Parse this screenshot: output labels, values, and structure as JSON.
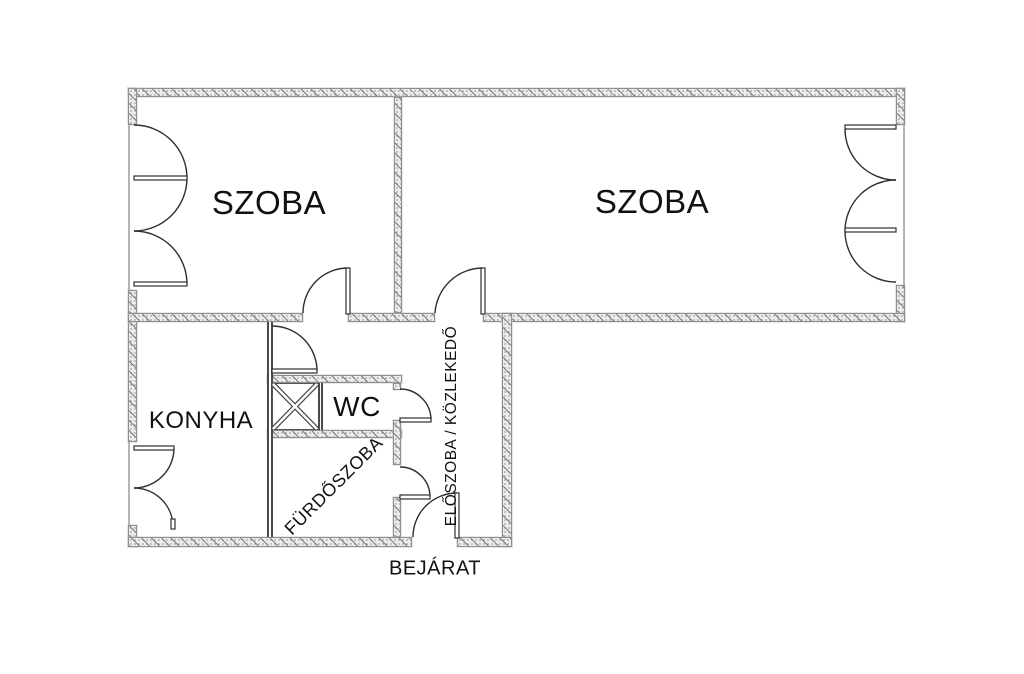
{
  "floorplan": {
    "labels": {
      "szoba_left": "SZOBA",
      "szoba_right": "SZOBA",
      "konyha": "KONYHA",
      "wc": "WC",
      "furdoszoba": "FÜRDŐSZOBA",
      "eloszoba": "ELŐSZOBA / KÖZLEKEDŐ",
      "bejarat": "BEJÁRAT"
    },
    "colors": {
      "background": "#ffffff",
      "wall-fill": "#ececec",
      "wall-hatch": "#7d7d7d",
      "wall-edge": "#8f8f8f",
      "line": "#2e2e2e",
      "text": "#111111"
    }
  }
}
